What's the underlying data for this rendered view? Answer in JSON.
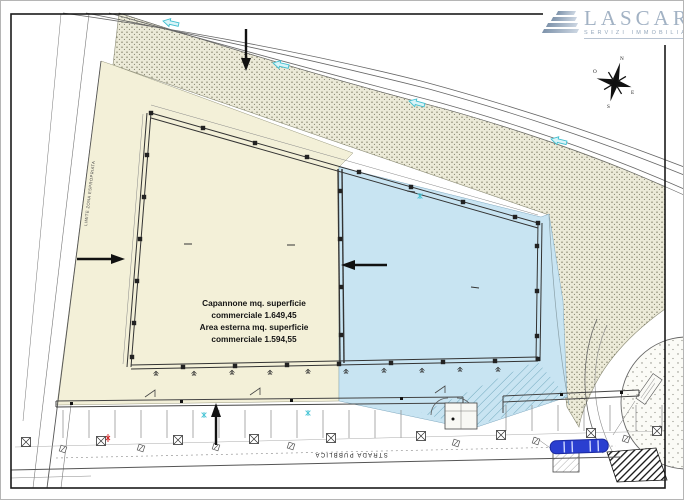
{
  "logo": {
    "name": "LASCARI",
    "tagline": "SERVIZI IMMOBILIARI"
  },
  "compass": {
    "north": "N",
    "west": "O",
    "east": "E",
    "south": "S"
  },
  "annotation": {
    "lines": [
      "Capannone mq. superficie",
      "commerciale 1.649,45",
      "Area esterna mq. superficie",
      "commerciale 1.594,55"
    ]
  },
  "labels": {
    "road": "STRADA PUBBLICA",
    "boundary": "LIMITE ZONA ESPROPRIATA"
  },
  "colors": {
    "parcel_yellow": "#f3f0d8",
    "building_blue": "#c8e4f2",
    "stipple_bg": "#ecead8",
    "cyan_marker": "#45c3d4",
    "logo_blue": "#a2b2c4",
    "car_blue": "#2a3fd0"
  }
}
